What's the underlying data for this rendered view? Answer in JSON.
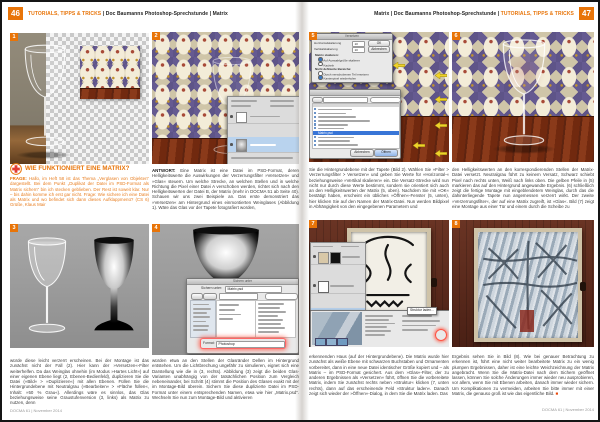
{
  "page": {
    "left_num": "46",
    "right_num": "47",
    "header_highlight": "TUTORIALS, TIPPS & TRICKS",
    "header_left_rest": " | Doc Baumanns Photoshop-Sprechstunde | Matrix",
    "header_right_prefix": "Matrix | Doc Baumanns Photoshop-Sprechstunde | ",
    "footer": "DOCMA 61 | November 2014"
  },
  "article": {
    "heading": "WIE FUNKTIONIERT EINE MATRIX?",
    "frage_label": "FRAGE:",
    "frage": " Hallo, im Heft 58 ist das Thema „Verglasen von Objekten“ dargestellt. Bei dem Punkt „Duplikat der Datei im PSD-Format als Matrix sichern“ bin ich stecken geblieben. Der Rest ist soweit klar. Nur – bis dahin komme ich erst gar nicht. Frage: Wie sichere ich eine Datei als Matrix und wo befindet sich dann dieses Aufklappmenü? (CS 6) Grüße, Klaus Mair",
    "antwort_label": "ANTWORT:",
    "antwort": " Eine Matrix ist eine Datei im PSD-Format, deren Helligkeitswerte die Auswirkungen der Verzerrungsfilter »Versetzen« und »Glas« steuern. Um welche Strecke, an welchen Stellen und in welche Richtung die Pixel einer Datei A verschoben werden, richtet sich nach den Helligkeitswerten der Datei B, der Matrix (mehr in DOCMA 51 ab Seite 40). Schauen wir uns zwei Beispiele an. Das erste demonstriert das »Versetzen« am Hintergrund eines einmontierten Weinglases (Abbildung 1). Wäre das Glas vor der Tapete fotografiert worden,",
    "col_a2": "würde diese leicht verzerrt erscheinen. Bei der Montage ist das zunächst nicht der Fall (2). Hier kann der »Versetzen«-Filter weiterhelfen. Da das Weinglas ohnehin (im Modus »Hartes Licht«) auf einer eigenen Ebene liegt (2, Ebenen-Bedienfeld), duplizieren Sie die Datei (»Bild« > »Duplizieren«) mit allen Ebenen. Füllen Sie die Hintergrundebene mit Neutralgrau (»Bearbeiten« > »Fläche füllen«, Inhalt: »50 % Grau«). Allerdings wäre es sinnlos, das Glas beziehungsweise seine Graustufenversion (3, links) als Matrix zu nutzen, denn",
    "col_b2": "würden etwa an den Stellen der Glasränder Dellen im Hintergrund entstehen. Um die Lichtbrechung ungefähr zu simulieren, eignet sich eine Darstellung wie die in (3, rechts). Abbildung (3) zeigt die beiden Glas-Varianten unabhängig von der tatsächlichen Position zum Vergleich nebeneinander, bei Schritt (4) stimmt die Position des Glases exakt mit der im Montage-Bild überein. Sichern Sie diese duplizierte Datei im PSD-Format unter einem entsprechenden Namen, etwa wie hier „Matrix.psd“. Wechseln Sie nun zum Montage-Bild und aktivieren",
    "col_r1a": "Sie die Hintergrundebene mit der Tapete (Bild 2). Wählen Sie »Filter > Verzerrungsfilter > Versetzen« und geben Sie Werte für »Horizontal-« beziehungsweise »Vertikal skalieren« ein. Die Versatz-Strecke wird nun nicht nur durch diese Werte bestimmt, sondern sie orientiert sich auch an den Helligkeitswerten der Matrix (5, oben). Nachdem Sie mit »OK« bestätigt haben, erscheint ein übliches »Öffnen«-Fenster (5, unten), hier klicken Sie auf den Namen der Matrix-Datei. Nun werden Bildpixel in Abhängigkeit von den eingegebenen Parametern und",
    "col_r1b": "den Helligkeitswerten an den korrespondierenden Stellen der Matrix-Datei versetzt. Neutralgrau führt zu keinem Versatz, Schwarz schiebt Pixel nach rechts unten, Weiß nach links oben. Die gelben Pfeile in (5) markieren das auf den Hintergrund angewandte Ergebnis. (6) schließlich zeigt die fertige Montage mit eingeblendetem Weinglas, durch das die dahinterliegende Tapete nun angemessen verzerrt wirkt. Der zweite »Verzerrungsfilter«, der auf eine Matrix zugreift, ist »Glas«. Bild (7) zeigt eine Montage aus einer Tür und einem durch die Scheibe zu",
    "col_r2a": "erkennenden Haus (auf der Hintergrundebene). Die Matrix wurde hier zunächst als weiße Ebene mit schwarzen Buchstaben und Ornamenten vorbereitet, dann in eine neue Datei identischer Größe kopiert und – als Matrix – im PSD-Format gesichert. Aus dem »Glas«-Filter, der zu anderen Ergebnissen als »Versetzen« führt, öffnen Sie die vorbereitete Matrix, indem Sie zunächst rechts neben »Struktur« klicken (7, unten rechts), dann auf das erscheinende Feld »Struktur laden«. Danach zeigt sich wieder der »Öffnen«-Dialog, in dem Sie die Matrix laden. Das",
    "col_r2b": "Ergebnis sehen Sie in Bild (8). Wie bei genauer Betrachtung zu erkennen ist, führt eine nicht weiter bearbeitete Matrix zu ein wenig plumpen Ergebnissen, daher ist eine leichte Weichzeichnung der Matrix angebracht. Wenn Sie die Matrix-Datei nach dem Sichern geöffnet lassen, können Sie solche Änderungen immer wieder neu ausprobieren, vor allem, wenn Sie mit Ebenen arbeiten, danach immer wieder sichern. Um Komplikationen zu vermeiden, arbeiten Sie bitte immer mit einer Matrix, die genauso groß ist wie das eigentliche Bild.",
    "end_mark": "■"
  },
  "figures": {
    "tabs": [
      "1",
      "2",
      "3",
      "4",
      "5",
      "6",
      "7",
      "8"
    ]
  },
  "dialogs": {
    "save": {
      "title": "Sichern unter",
      "label": "Sichern unter:",
      "filename": "Matrix.psd",
      "format_label": "Format:",
      "format_value": "Photoshop"
    },
    "displace": {
      "title": "Versetzen",
      "h_label": "Horizontalskalierung",
      "h_value": "10",
      "v_label": "Vertikalskalierung",
      "v_value": "10",
      "ok": "OK",
      "cancel": "Abbrechen",
      "group1": "Matrix skalieren:",
      "opt1": "Auf Auswahlgröße skalieren",
      "opt2": "Kacheln",
      "group2": "Nicht definierte Bereiche:",
      "opt3": "Durch verschobenen Teil ersetzen",
      "opt4": "Kantenpixel wiederholen"
    },
    "open": {
      "selected_file": "Matrix.psd",
      "cancel": "Abbrechen",
      "open": "Öffnen"
    },
    "glass": {
      "load_texture": "Struktur laden..."
    }
  },
  "colors": {
    "accent_orange": "#e87408",
    "question_orange": "#e87e20",
    "selection_blue": "#3875d7",
    "arrow_yellow": "#f0d22b"
  }
}
